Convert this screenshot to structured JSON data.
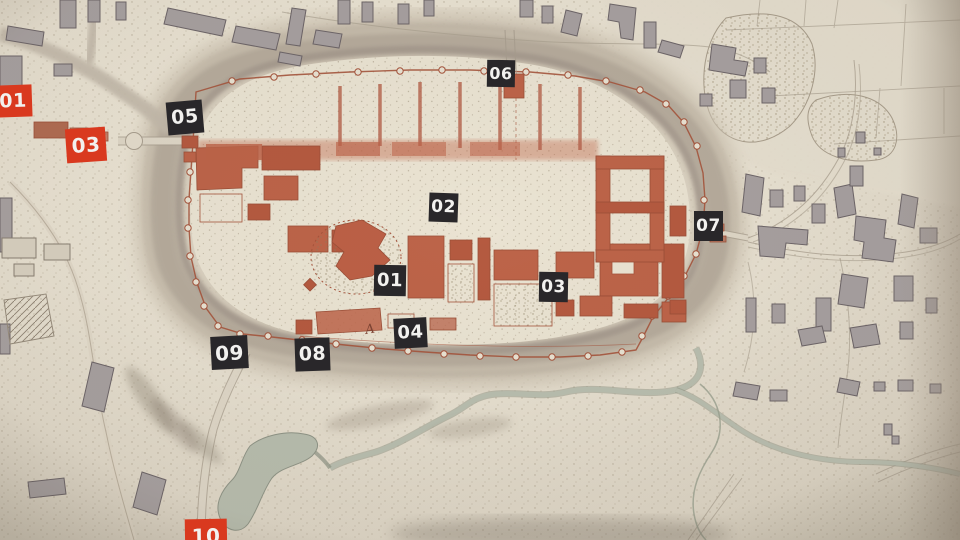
{
  "map": {
    "annotation": "A",
    "markers": [
      {
        "id": "red-01",
        "label": "01",
        "variant": "red"
      },
      {
        "id": "red-03",
        "label": "03",
        "variant": "red"
      },
      {
        "id": "black-05",
        "label": "05",
        "variant": "black"
      },
      {
        "id": "black-06",
        "label": "06",
        "variant": "black"
      },
      {
        "id": "black-02",
        "label": "02",
        "variant": "black"
      },
      {
        "id": "black-07",
        "label": "07",
        "variant": "black"
      },
      {
        "id": "black-01",
        "label": "01",
        "variant": "black"
      },
      {
        "id": "black-03",
        "label": "03",
        "variant": "black"
      },
      {
        "id": "black-04",
        "label": "04",
        "variant": "black"
      },
      {
        "id": "black-08",
        "label": "08",
        "variant": "black"
      },
      {
        "id": "black-09",
        "label": "09",
        "variant": "black"
      },
      {
        "id": "red-10",
        "label": "10",
        "variant": "red"
      }
    ],
    "colors": {
      "marker_black": "#29272a",
      "marker_red": "#d9391f",
      "marker_text": "#f2f1ef",
      "paper": "#e8e1d1",
      "fortress_building_red": "#bd6449",
      "village_building_gray": "#a7a0a0",
      "rampart": "#b5aa9b",
      "wall_line_red": "#a5543c",
      "water": "#b8bdae"
    }
  }
}
